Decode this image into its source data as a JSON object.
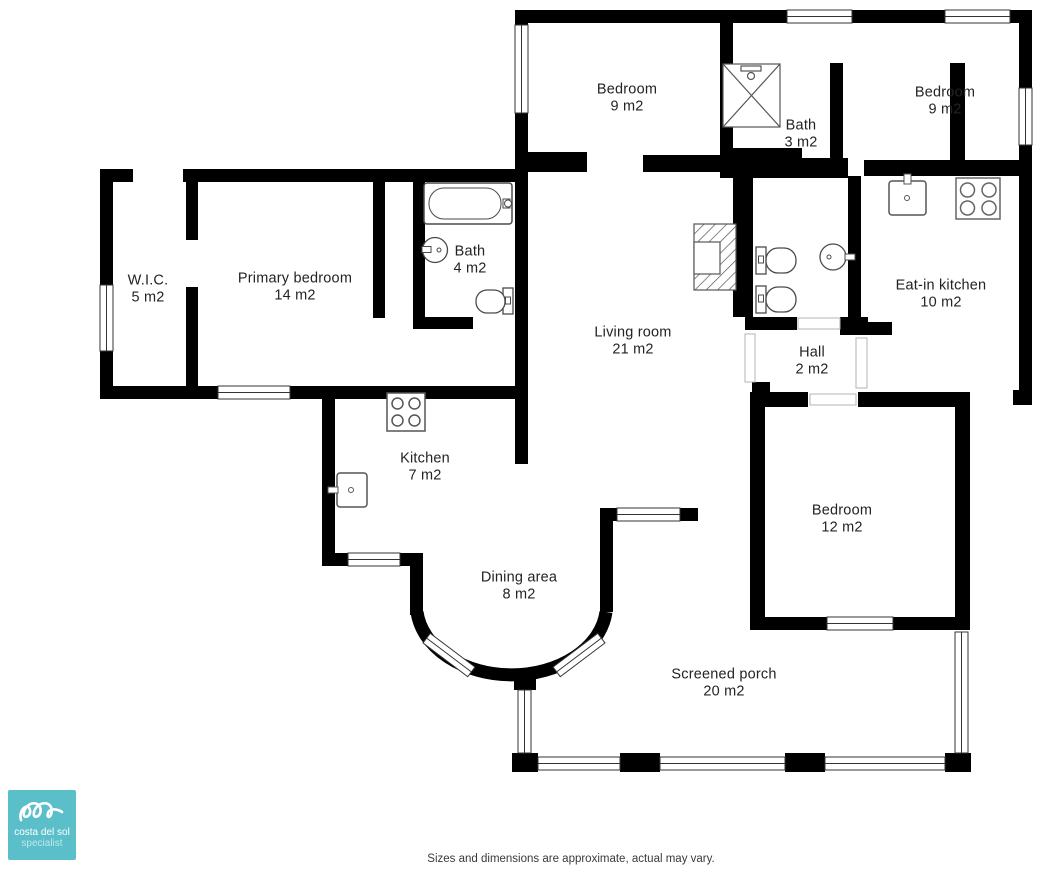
{
  "plan": {
    "rooms": [
      {
        "id": "wic",
        "name": "W.I.C.",
        "area": "5 m2"
      },
      {
        "id": "primary-bedroom",
        "name": "Primary bedroom",
        "area": "14 m2"
      },
      {
        "id": "bath-primary",
        "name": "Bath",
        "area": "4 m2"
      },
      {
        "id": "bedroom-top-left",
        "name": "Bedroom",
        "area": "9 m2"
      },
      {
        "id": "bath-shower",
        "name": "Bath",
        "area": "3 m2"
      },
      {
        "id": "bedroom-top-right",
        "name": "Bedroom",
        "area": "9 m2"
      },
      {
        "id": "eat-in-kitchen",
        "name": "Eat-in kitchen",
        "area": "10 m2"
      },
      {
        "id": "living-room",
        "name": "Living room",
        "area": "21 m2"
      },
      {
        "id": "hall",
        "name": "Hall",
        "area": "2 m2"
      },
      {
        "id": "kitchen",
        "name": "Kitchen",
        "area": "7 m2"
      },
      {
        "id": "bedroom-right",
        "name": "Bedroom",
        "area": "12 m2"
      },
      {
        "id": "dining-area",
        "name": "Dining area",
        "area": "8 m2"
      },
      {
        "id": "screened-porch",
        "name": "Screened porch",
        "area": "20 m2"
      }
    ],
    "fixtures": [
      "bathtub-icon",
      "shower-icon",
      "toilet-icon",
      "round-sink-icon",
      "kitchen-sink-icon",
      "stove-icon",
      "fireplace-icon",
      "window",
      "door-opening"
    ],
    "logo": {
      "title": "costa del sol",
      "subtitle": "specialist",
      "color": "#5bbfca"
    },
    "footer": "Sizes and dimensions are approximate, actual may vary.",
    "colors": {
      "wall": "#000000",
      "fixture_stroke": "#4a4a4a",
      "label_text": "#232323",
      "logo_teal": "#5bbfca"
    }
  }
}
